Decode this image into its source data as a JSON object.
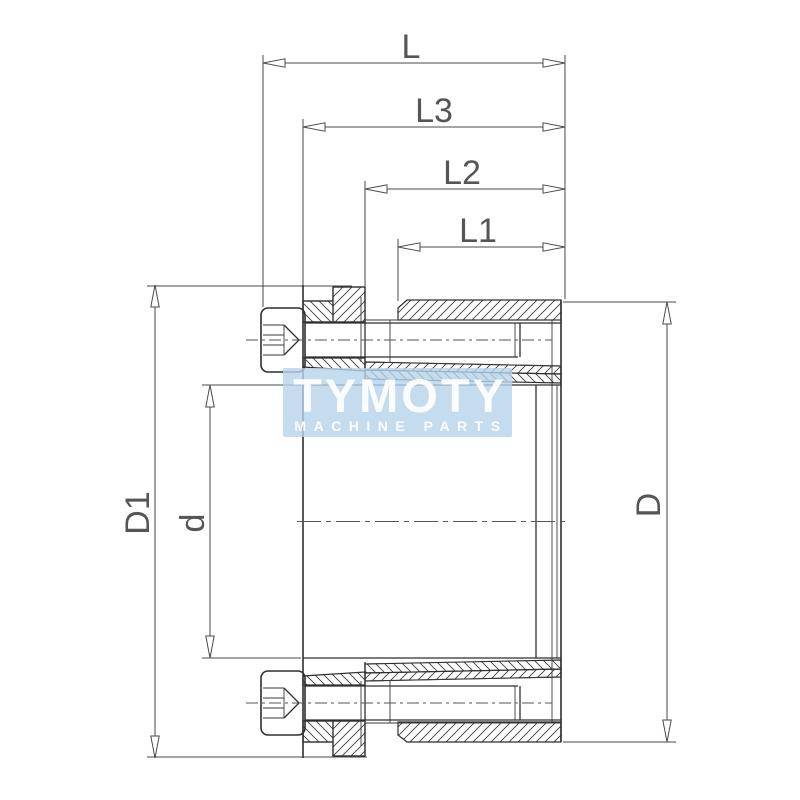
{
  "labels": {
    "l": "L",
    "l3": "L3",
    "l2": "L2",
    "l1": "L1",
    "d1": "D1",
    "d_lower": "d",
    "d_upper": "D"
  },
  "watermark": {
    "line1": "TYMOTY",
    "line2": "MACHINE PARTS",
    "bg_color": "#b7d3ea",
    "text_color": "#ffffff"
  },
  "colors": {
    "line": "#2f2f2f",
    "dimension": "#4a4a4a"
  }
}
